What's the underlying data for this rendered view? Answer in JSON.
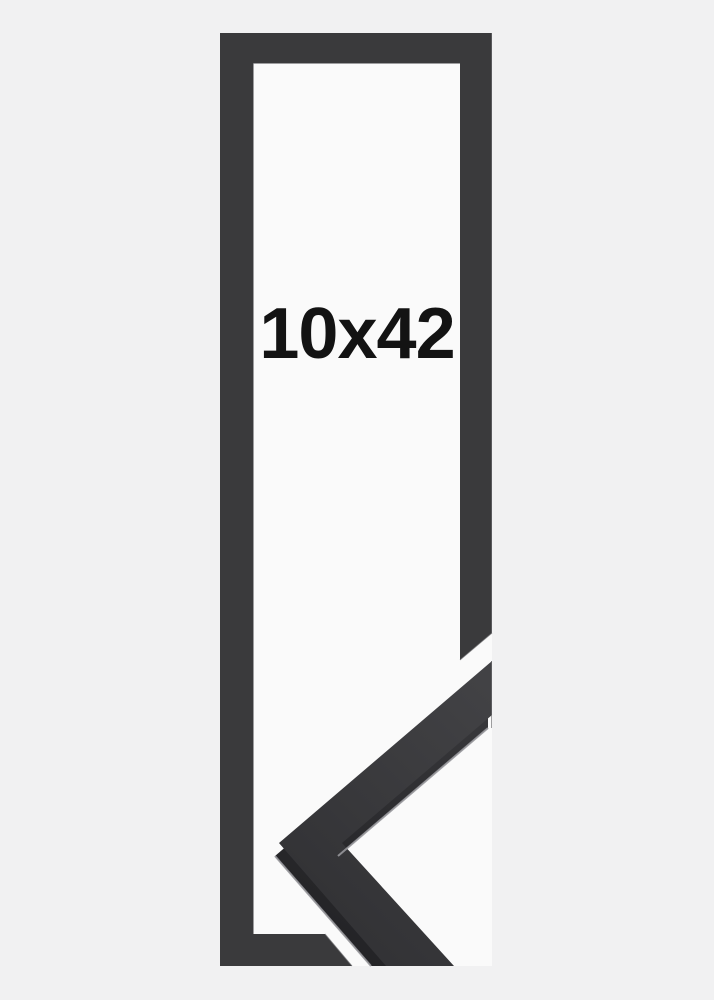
{
  "product_image": {
    "size_label": "10x42"
  },
  "colors": {
    "background": "#f1f1f2",
    "panel": "#fafafa",
    "frame": "#3a3a3c",
    "frame_face_light": "#424245",
    "frame_face_dark": "#313134",
    "side_light": "#38383b",
    "side_dark": "#212124",
    "specular": "#97979b",
    "edge_highlight": "#6b6b6f",
    "label_text": "#131313"
  }
}
